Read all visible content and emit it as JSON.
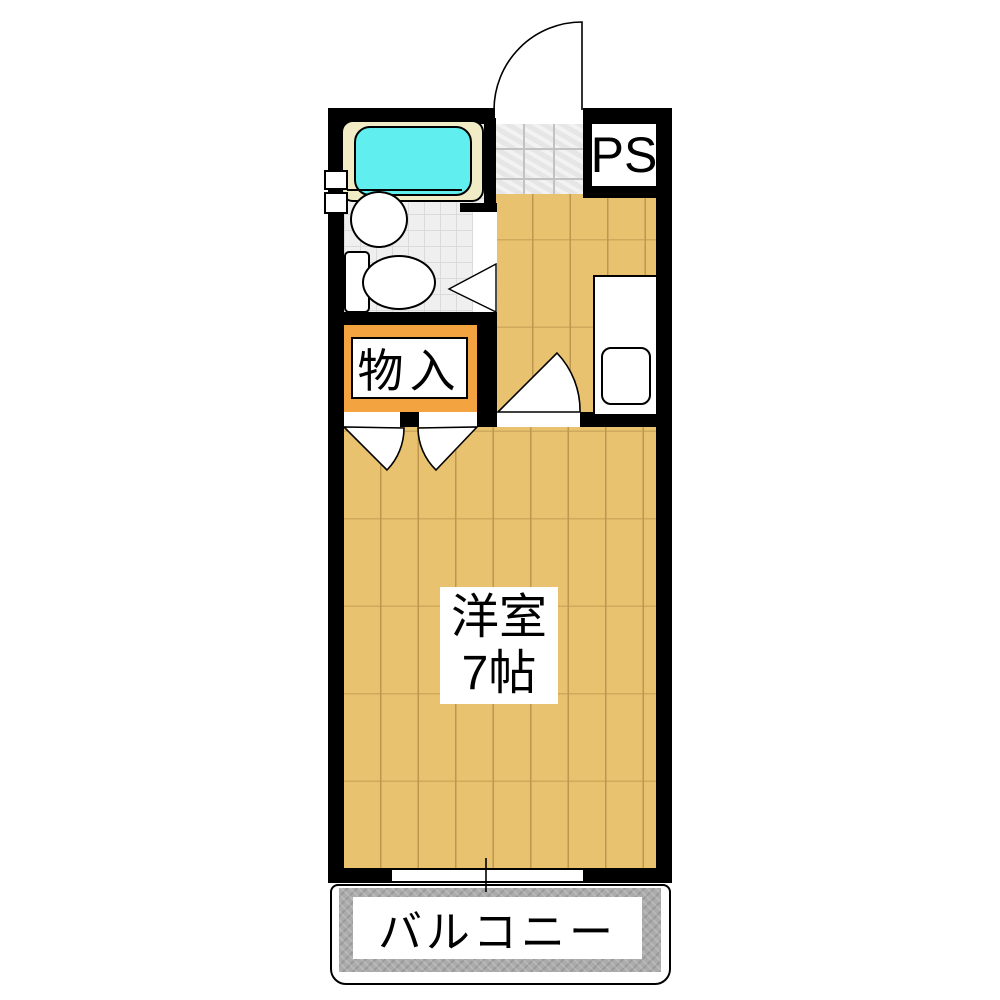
{
  "labels": {
    "pipe_space": "PS",
    "closet": "物入",
    "main_room_name": "洋室",
    "main_room_size": "7帖",
    "balcony": "バルコニー"
  },
  "colors": {
    "wall": "#000000",
    "wood_floor": "#e8c26f",
    "wood_seam": "#bd9750",
    "closet_fill": "#f3a440",
    "bathtub_water": "#60eeee",
    "bathtub_rim": "#f1ecc6",
    "bath_tile_floor": "#efefef",
    "bath_tile_line": "#dadada",
    "entry_tile_floor": "#e6e6e6",
    "entry_tile_line": "#c2c2c2",
    "balcony_concrete": "#ababab",
    "label_background": "#ffffff",
    "label_text": "#000000"
  }
}
